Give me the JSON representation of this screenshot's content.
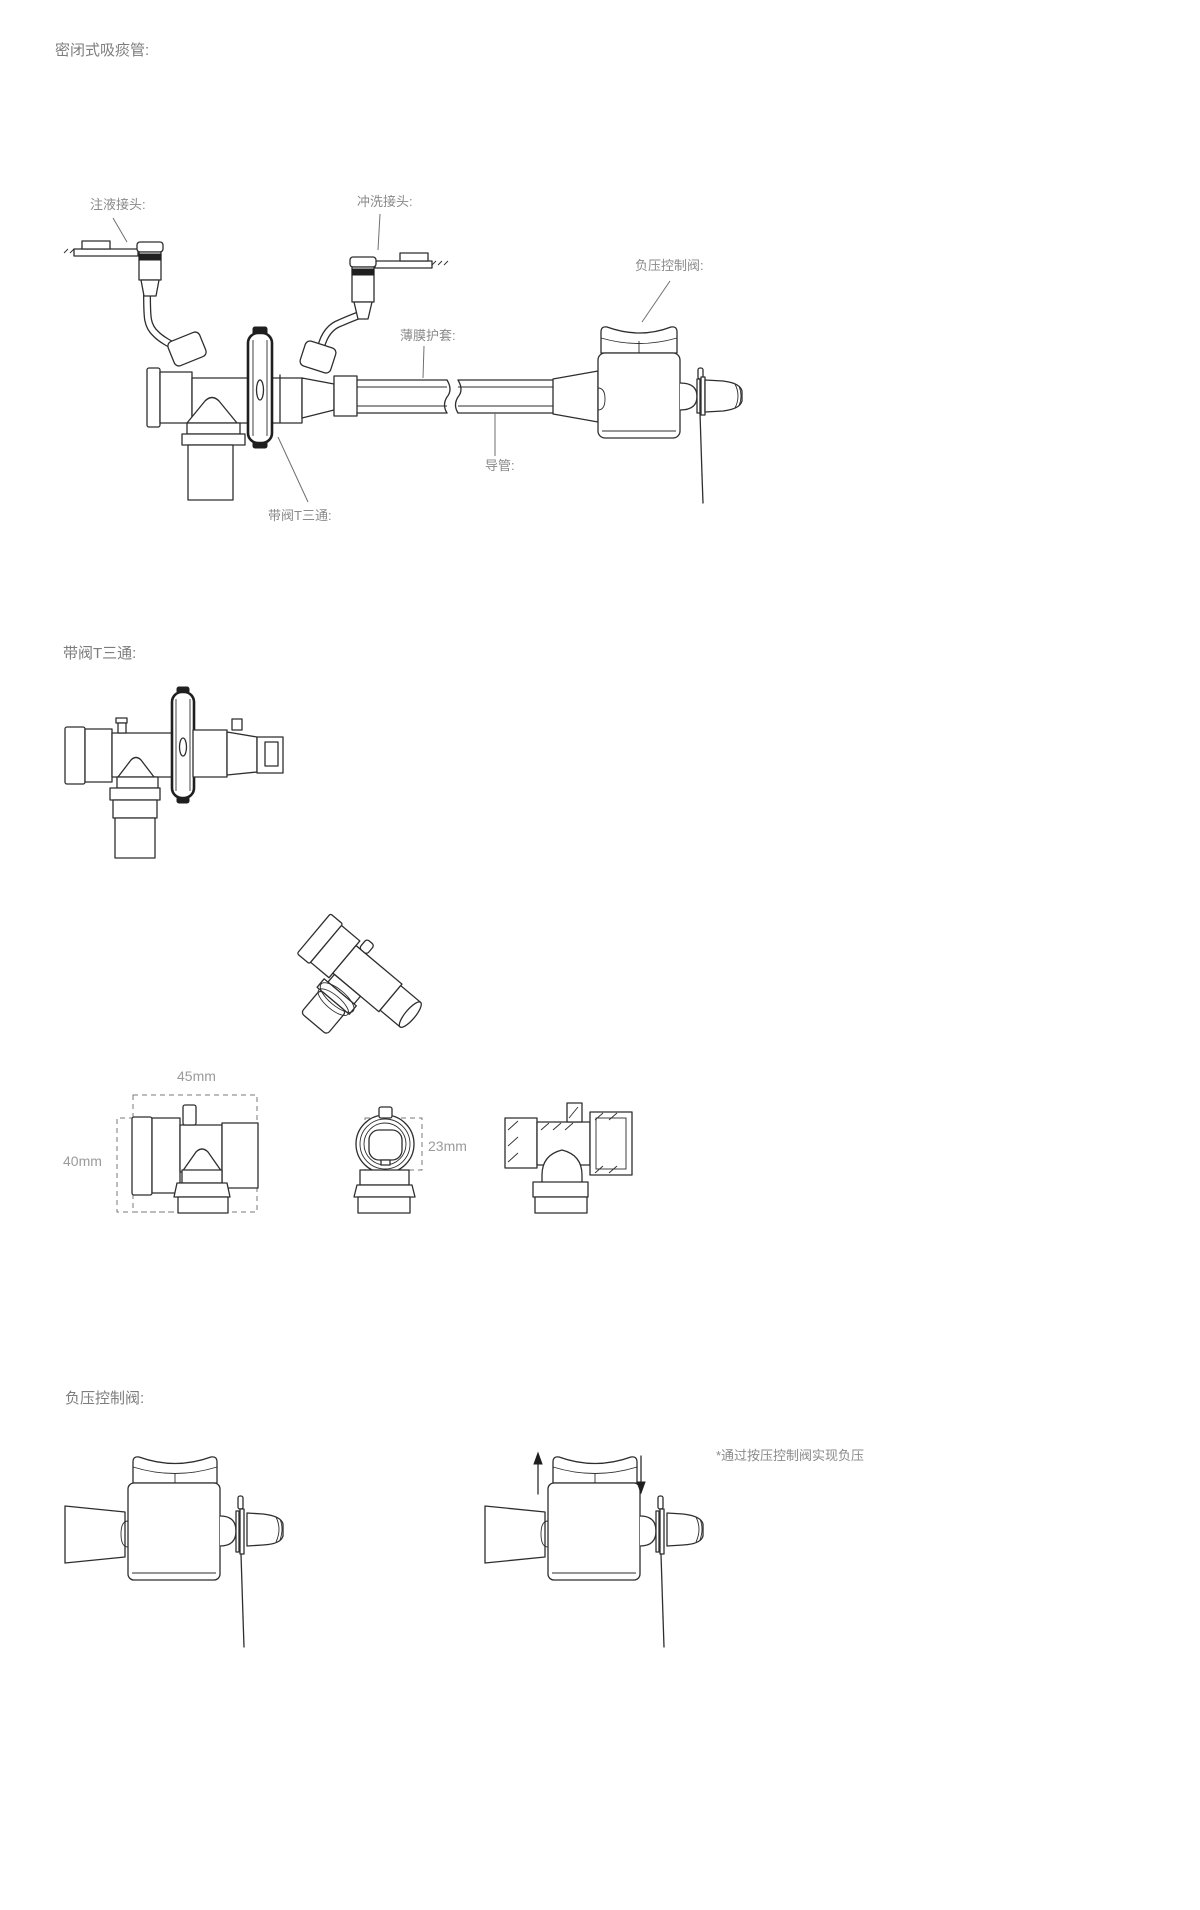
{
  "page": {
    "title": "密闭式吸痰管:"
  },
  "main_diagram": {
    "labels": {
      "injection_port": "注液接头:",
      "flush_port": "冲洗接头:",
      "pressure_valve": "负压控制阀:",
      "film_sheath": "薄膜护套:",
      "catheter": "导管:",
      "t_connector": "带阀T三通:"
    }
  },
  "t_connector_section": {
    "title": "带阀T三通:",
    "dimensions": {
      "width": "45mm",
      "height": "40mm",
      "diameter": "23mm"
    }
  },
  "valve_section": {
    "title": "负压控制阀:",
    "note": "*通过按压控制阀实现负压"
  },
  "colors": {
    "line": "#2e2e2e",
    "text": "#8a8a8a"
  }
}
